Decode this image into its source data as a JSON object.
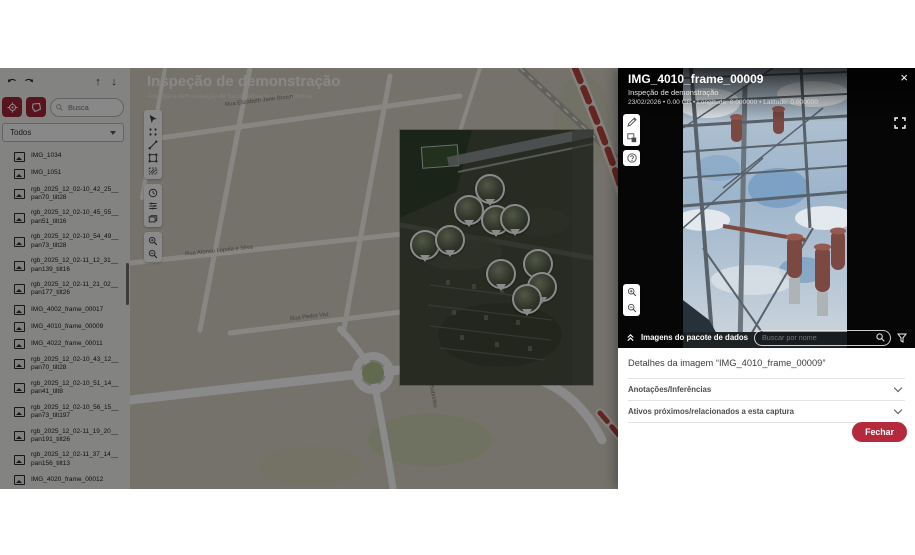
{
  "icons": {
    "arrow_up": "↑",
    "arrow_down": "↓",
    "close": "×"
  },
  "sidebar": {
    "search_placeholder": "Busca",
    "filter_value": "Todos",
    "items": [
      {
        "label": "IMG_1034"
      },
      {
        "label": "IMG_1051"
      },
      {
        "label": "rgb_2025_12_02-10_42_25__pan70_tilt28"
      },
      {
        "label": "rgb_2025_12_02-10_45_55__pan51_tilt16"
      },
      {
        "label": "rgb_2025_12_02-10_54_49__pan73_tilt28"
      },
      {
        "label": "rgb_2025_12_02-11_12_31__pan139_tilt16"
      },
      {
        "label": "rgb_2025_12_02-11_21_02__pan177_tilt26"
      },
      {
        "label": "IMG_4002_frame_00017"
      },
      {
        "label": "IMG_4010_frame_00009"
      },
      {
        "label": "IMG_4022_frame_00011"
      },
      {
        "label": "rgb_2025_12_02-10_43_12__pan70_tilt28"
      },
      {
        "label": "rgb_2025_12_02-10_51_14__pan41_tilt8"
      },
      {
        "label": "rgb_2025_12_02-10_56_15__pan73_tilt197"
      },
      {
        "label": "rgb_2025_12_02-11_19_20__pan191_tilt26"
      },
      {
        "label": "rgb_2025_12_02-11_37_14__pan156_tilt13"
      },
      {
        "label": "IMG_4020_frame_00012"
      },
      {
        "label": "IMG_4028_frame_00017"
      }
    ]
  },
  "map": {
    "title": "Inspeção de demonstração",
    "subtitle": "Área para demonstração de funcionalidades da plataforma",
    "street_labels": [
      {
        "text": "Rua Elizabeth Jane Brown"
      },
      {
        "text": "Rua Pedro Vaz"
      },
      {
        "text": "Rua Afonso Lopola e Silva"
      },
      {
        "text": "Rua José Doutra Sobrinho"
      }
    ]
  },
  "viewer": {
    "title": "IMG_4010_frame_00009",
    "subtitle": "Inspeção de demonstração",
    "meta": "23/02/2026  •  0.00 GB  •  Longitude: 0.000000  •  Latitude: 0.000000",
    "package_label": "Imagens do pacote de dados",
    "search_placeholder": "Buscar por nome"
  },
  "details": {
    "title": "Detalhes da imagem “IMG_4010_frame_00009”",
    "accordion_annotations": "Anotações/Inferências",
    "accordion_assets": "Ativos próximos/relacionados a esta captura",
    "close_button": "Fechar"
  },
  "colors": {
    "accent_red": "#b5293c",
    "sidebar_button_red": "#a32638"
  }
}
